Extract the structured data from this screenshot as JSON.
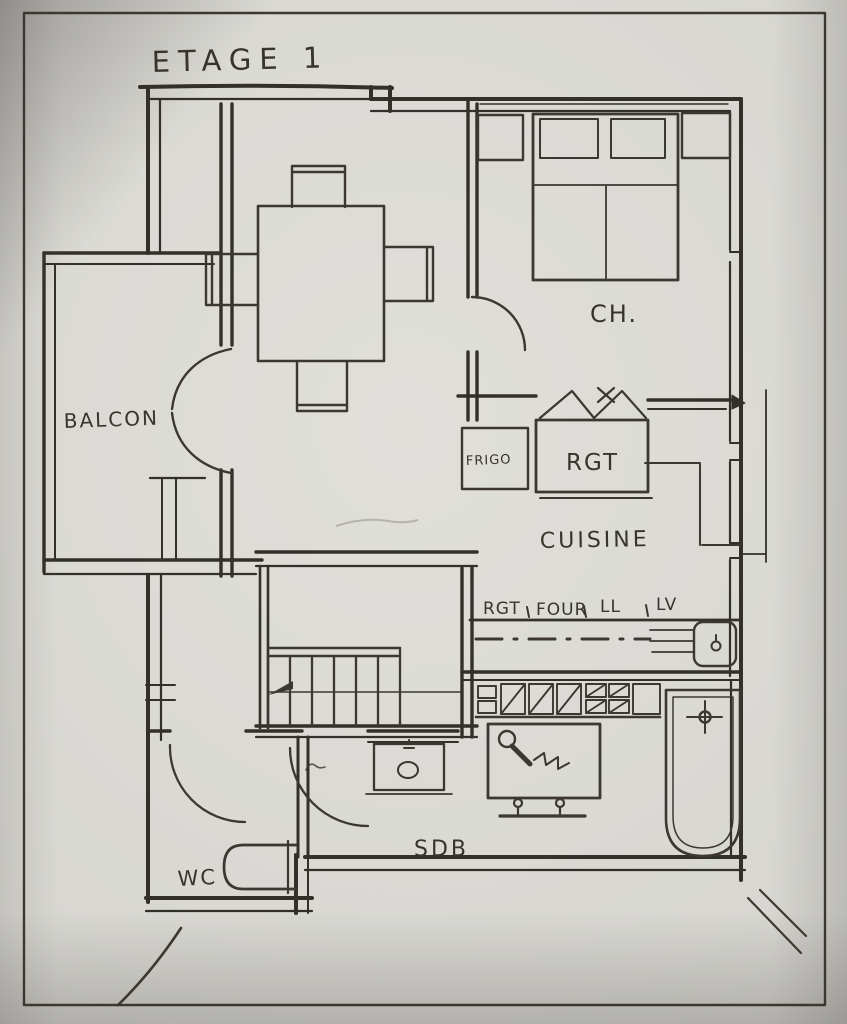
{
  "page": {
    "title": "ETAGE 1"
  },
  "rooms": {
    "balcony": "BALCON",
    "bedroom": "CH.",
    "kitchen": "CUISINE",
    "bathroom": "SDB",
    "wc": "WC"
  },
  "kitchen": {
    "fridge": "FRIGO",
    "storage": "RGT",
    "counter": [
      "RGT",
      "FOUR",
      "LL",
      "LV"
    ]
  },
  "icons": {
    "stairs_direction": "arrow-icon",
    "bifold_closet_doors": "bifold-door-icon",
    "shower_head": "hand-shower-icon",
    "sink_faucet": "faucet-icon",
    "bathtub_tap": "cross-tap-icon"
  },
  "colors": {
    "paper": "#d7d6d1",
    "ink": "#38342c",
    "frame": "#2b2824"
  }
}
